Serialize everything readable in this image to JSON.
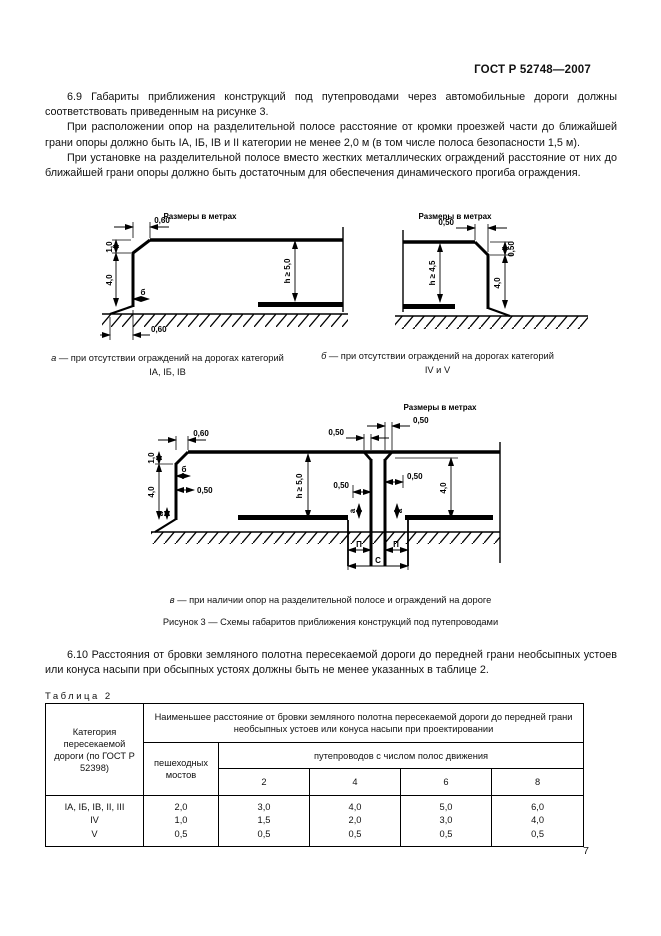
{
  "page": {
    "header": "ГОСТ Р 52748—2007",
    "number": "7"
  },
  "paragraphs": {
    "p69a": "6.9  Габариты приближения конструкций под путепроводами через автомобильные дороги должны соответствовать приведенным на рисунке 3.",
    "p69b": "При расположении опор на разделительной полосе расстояние от кромки проезжей части до ближайшей грани опоры должно быть IА, IБ, IВ и II категории не менее 2,0 м (в том числе полоса безопасности 1,5 м).",
    "p69c": "При установке на разделительной полосе вместо жестких металлических ограждений расстояние от них до ближайшей грани опоры должно быть достаточным для обеспечения динамического прогиба ограждения.",
    "p610": "6.10  Расстояния от бровки земляного полотна пересекаемой дороги до передней грани необсыпных устоев или конуса насыпи при обсыпных устоях должны быть не менее указанных в таблице 2."
  },
  "figure": {
    "units_label": "Размеры в метрах",
    "caption_a": {
      "letter": "а",
      "text": " — при отсутствии ограждений на дорогах категорий",
      "cats": "IА, IБ, IВ"
    },
    "caption_b": {
      "letter": "б",
      "text": " — при отсутствии ограждений на дорогах категорий",
      "cats": "IV и V"
    },
    "caption_v": {
      "letter": "в",
      "text": " — при наличии опор на разделительной полосе и ограждений на дороге"
    },
    "title": "Рисунок 3 — Схемы габаритов приближения конструкций под путепроводами"
  },
  "fig_a": {
    "d_top": "0,60",
    "d_1": "1,0",
    "d_4": "4,0",
    "h": "h ≥ 5,0",
    "b": "б",
    "d_bot": "0,60"
  },
  "fig_b": {
    "d_top": "0,50",
    "d_ch": "0,50",
    "h": "h ≥ 4,5",
    "d_4": "4,0"
  },
  "fig_v": {
    "d_1": "1,0",
    "d_top": "0,60",
    "d_4l": "4,0",
    "b": "б",
    "d_05l": "0,50",
    "h": "h ≥ 5,0",
    "d_mtl": "0,50",
    "d_mtr": "0,50",
    "d_mml": "0,50",
    "d_mmr": "0,50",
    "d_4r": "4,0",
    "a1": "а",
    "a2": "а",
    "a3": "а",
    "p1": "П",
    "p2": "П",
    "c": "С"
  },
  "table": {
    "label": "Таблица 2",
    "col1_header": "Категория пересекаемой дороги (по ГОСТ Р 52398)",
    "span_header": "Наименьшее расстояние от бровки земляного полотна пересекаемой дороги до передней грани необсыпных устоев или конуса насыпи при проектировании",
    "col2_header": "пешеходных мостов",
    "span2_header": "путепроводов с числом полос движения",
    "lanes": [
      "2",
      "4",
      "6",
      "8"
    ],
    "rows": [
      {
        "category": "IА, IБ, IВ, II, III",
        "values": [
          "2,0",
          "3,0",
          "4,0",
          "5,0",
          "6,0"
        ]
      },
      {
        "category": "IV",
        "values": [
          "1,0",
          "1,5",
          "2,0",
          "3,0",
          "4,0"
        ]
      },
      {
        "category": "V",
        "values": [
          "0,5",
          "0,5",
          "0,5",
          "0,5",
          "0,5"
        ]
      }
    ]
  }
}
